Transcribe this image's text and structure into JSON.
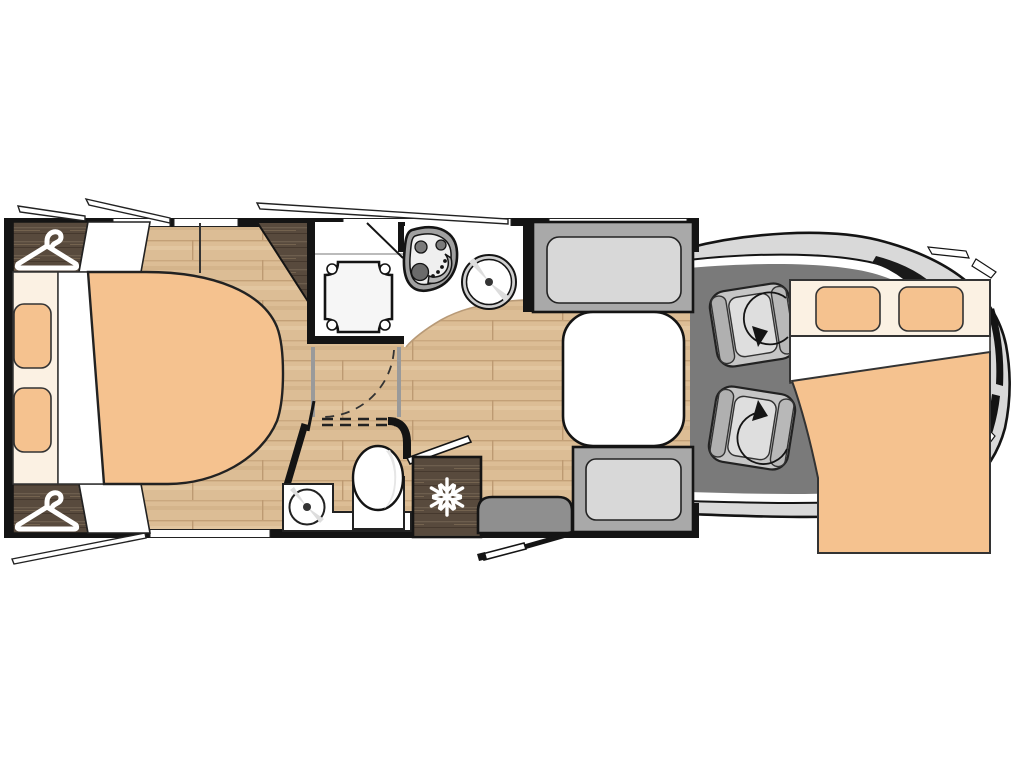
{
  "palette": {
    "peach": "#f5c28f",
    "cream": "#fbf1e3",
    "wall": "#141414",
    "wood-light": "#dcbd95",
    "wood-dark": "#584a3d",
    "cab-floor": "#7a7a7a",
    "body-grey": "#d9d9d9",
    "bench-grey": "#a9a9a9",
    "cushion-grey": "#d8d8d8",
    "seat-grey": "#c6c6c6",
    "step-grey": "#8f8f8f"
  },
  "floorplan": {
    "aria_label": "Motorhome floor plan, top-down view",
    "view": "top-down",
    "areas": {
      "rear_bedroom": {
        "name": "rear island bed bedroom",
        "features": [
          "island-bed",
          "mattress",
          "pillow",
          "pillow",
          "wardrobe",
          "wardrobe",
          "corner-cabinet"
        ]
      },
      "washroom": {
        "name": "washroom",
        "features": [
          "shower-cubicle",
          "shower-tray",
          "toilet",
          "washbasin",
          "vanity-counter",
          "folding-door"
        ]
      },
      "kitchen": {
        "name": "kitchen",
        "features": [
          "three-burner-hob",
          "round-sink",
          "worktop",
          "refrigerator"
        ]
      },
      "dinette": {
        "name": "dinette",
        "features": [
          "table",
          "bench-seat",
          "bench-seat"
        ]
      },
      "cab": {
        "name": "driver cab",
        "features": [
          "swivel-seat",
          "swivel-seat",
          "drop-down-bed",
          "pillow",
          "pillow"
        ]
      },
      "entrance": {
        "name": "entrance",
        "features": [
          "entry-step",
          "open-entry-door"
        ]
      }
    },
    "icons": {
      "wardrobe": "clothes-hanger-icon",
      "refrigerator": "snowflake-icon",
      "swivel_seat": "rotation-arrow-icon"
    },
    "counts": {
      "swivel_seats": 2,
      "wardrobes": 2,
      "beds": 2,
      "open_window_flaps": 4
    }
  }
}
